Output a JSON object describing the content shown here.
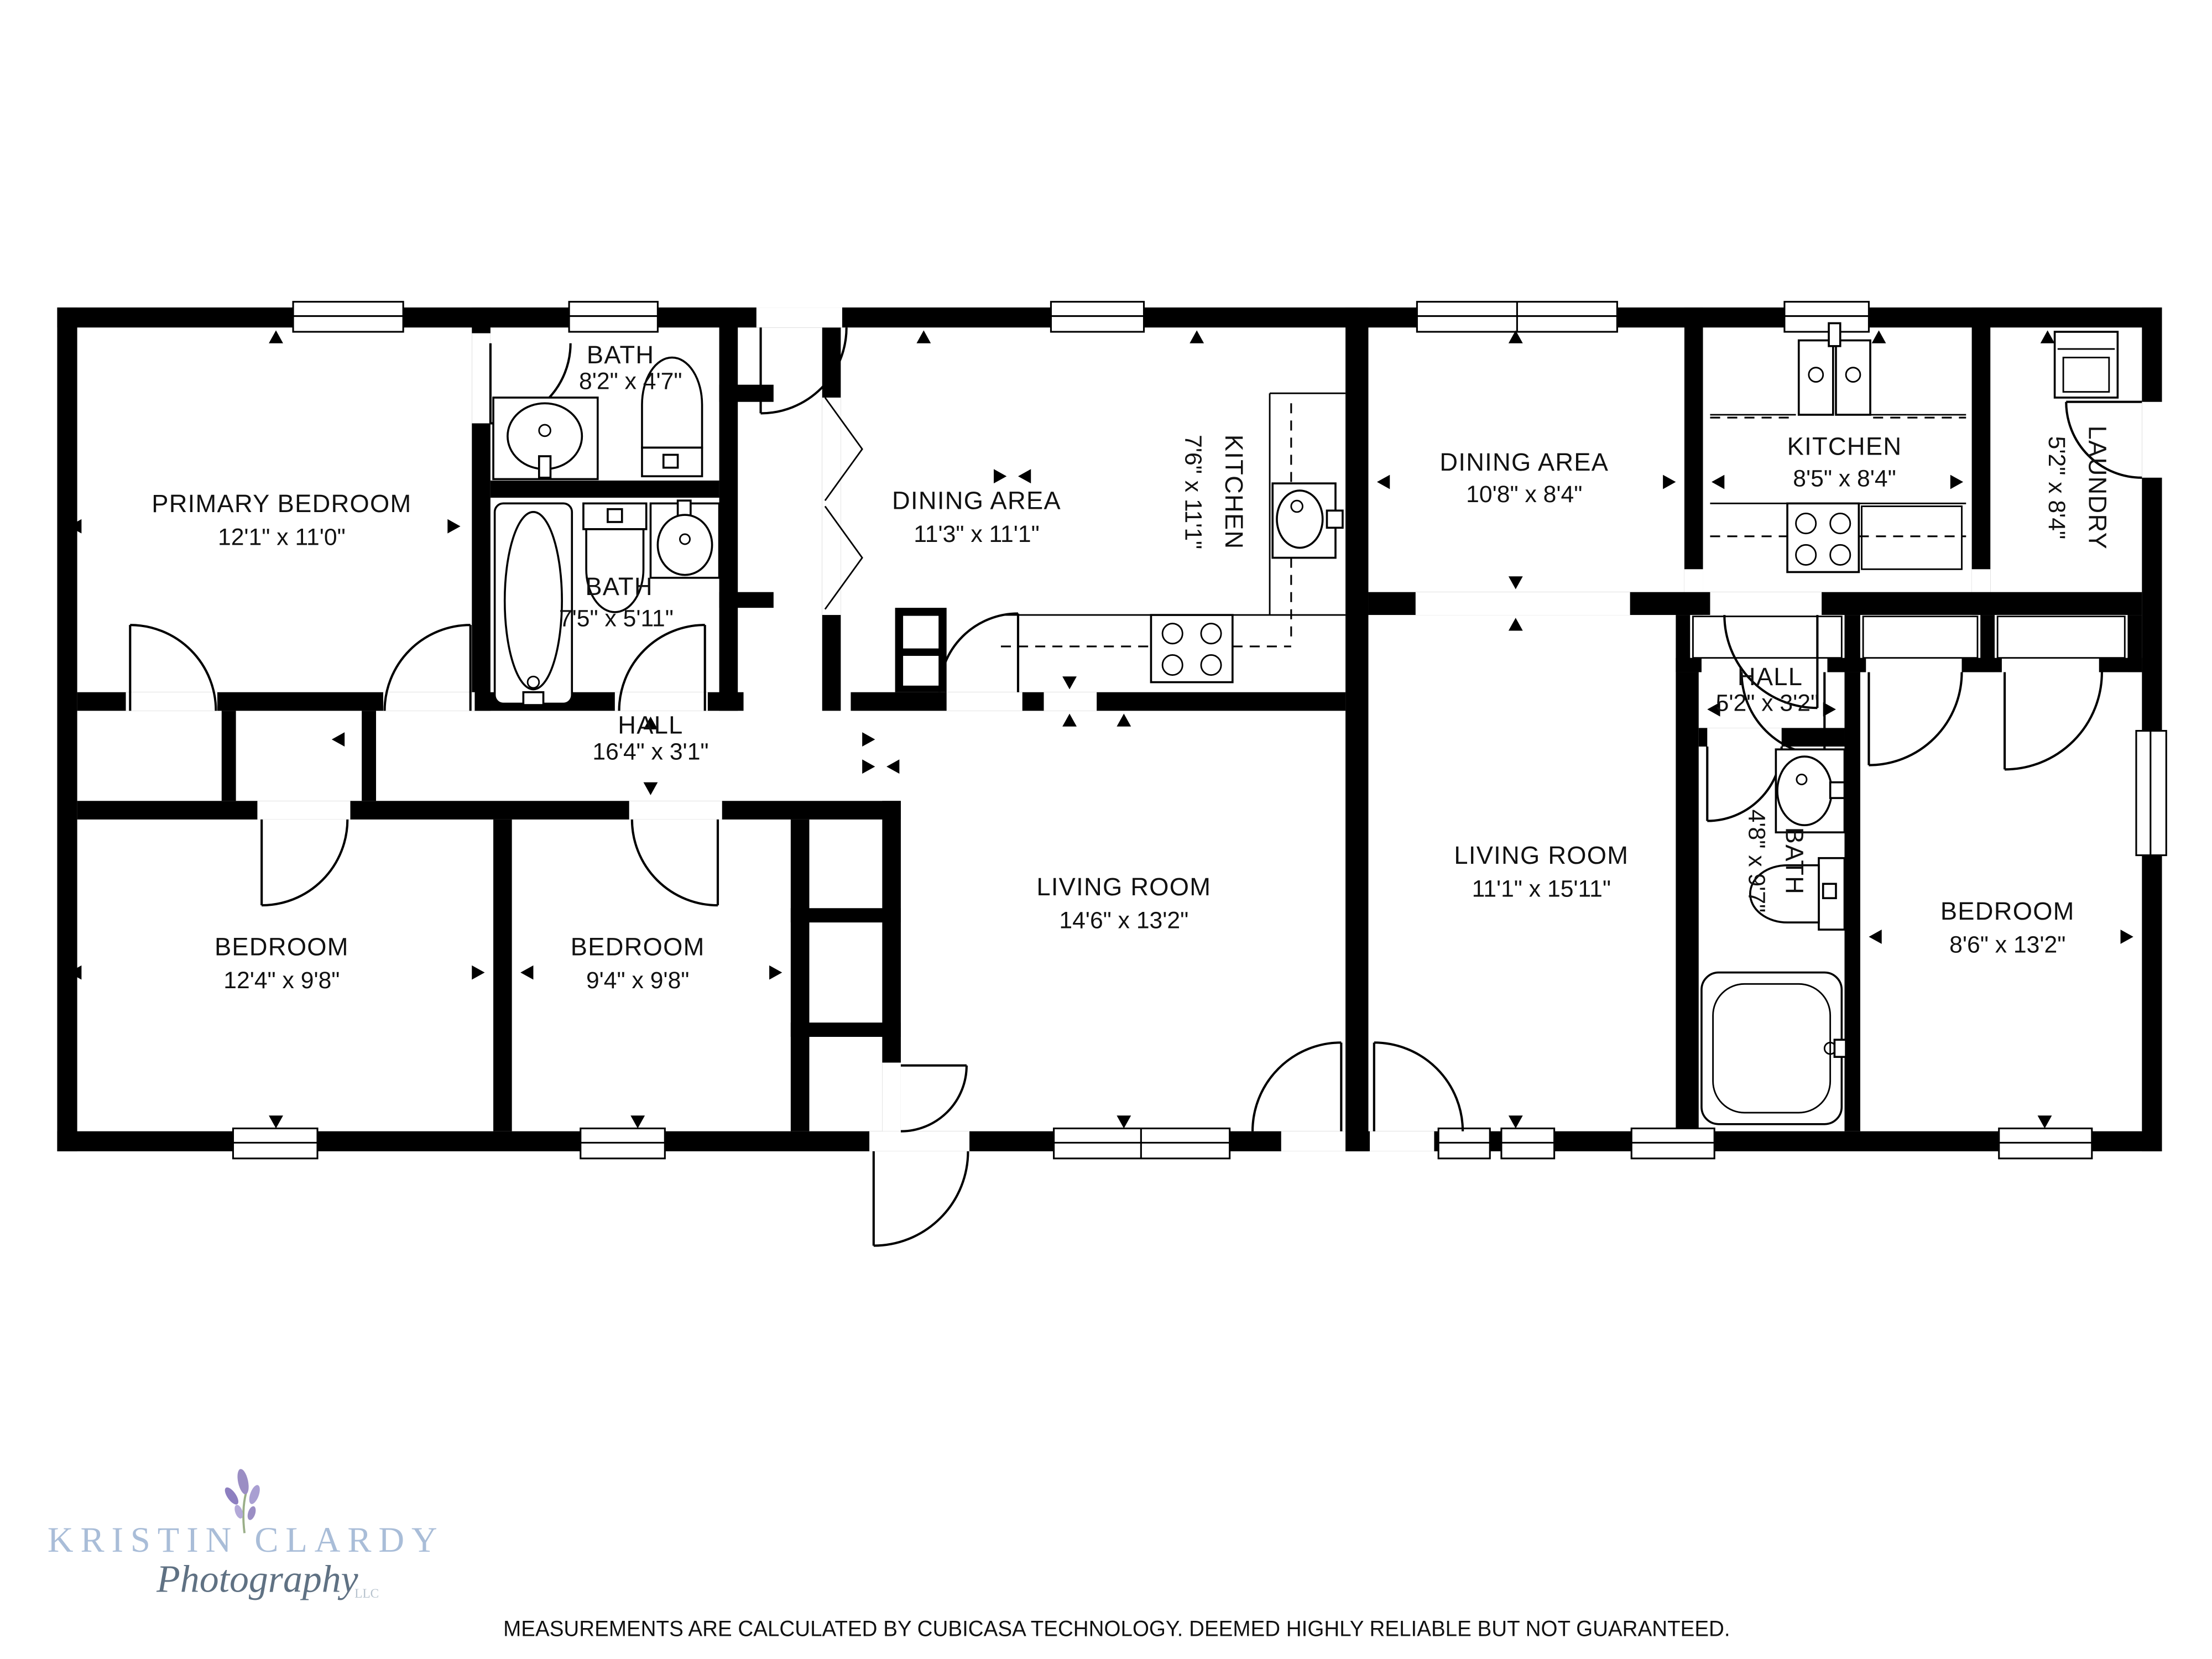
{
  "rooms": {
    "primary_bedroom": {
      "name": "PRIMARY BEDROOM",
      "dims": "12'1\" x 11'0\""
    },
    "bath_1": {
      "name": "BATH",
      "dims": "8'2\" x 4'7\""
    },
    "bath_2": {
      "name": "BATH",
      "dims": "7'5\" x 5'11\""
    },
    "dining_left": {
      "name": "DINING AREA",
      "dims": "11'3\" x 11'1\""
    },
    "kitchen_left": {
      "name": "KITCHEN",
      "dims": "7'6\" x 11'1\""
    },
    "hall_left": {
      "name": "HALL",
      "dims": "16'4\" x 3'1\""
    },
    "bedroom_1": {
      "name": "BEDROOM",
      "dims": "12'4\" x 9'8\""
    },
    "bedroom_2": {
      "name": "BEDROOM",
      "dims": "9'4\" x 9'8\""
    },
    "living_left": {
      "name": "LIVING ROOM",
      "dims": "14'6\" x 13'2\""
    },
    "dining_right": {
      "name": "DINING AREA",
      "dims": "10'8\" x 8'4\""
    },
    "kitchen_right": {
      "name": "KITCHEN",
      "dims": "8'5\" x 8'4\""
    },
    "laundry": {
      "name": "LAUNDRY",
      "dims": "5'2\" x 8'4\""
    },
    "hall_right": {
      "name": "HALL",
      "dims": "5'2\" x 3'2\""
    },
    "living_right": {
      "name": "LIVING ROOM",
      "dims": "11'1\" x 15'11\""
    },
    "bath_right": {
      "name": "BATH",
      "dims": "4'8\" x 9'7\""
    },
    "bedroom_3": {
      "name": "BEDROOM",
      "dims": "8'6\" x 13'2\""
    }
  },
  "watermark": {
    "line1": "KRISTIN CLARDY",
    "line2": "Photography",
    "line3": "LLC",
    "color_title": "#a9bdd8",
    "color_script": "#5f7183",
    "color_llc": "#b6c2cd",
    "color_flower": "#9b8ec4"
  },
  "footer": {
    "disclaimer": "MEASUREMENTS ARE CALCULATED BY CUBICASA TECHNOLOGY. DEEMED HIGHLY RELIABLE BUT NOT GUARANTEED."
  },
  "colors": {
    "wall": "#000000",
    "background": "#ffffff"
  }
}
